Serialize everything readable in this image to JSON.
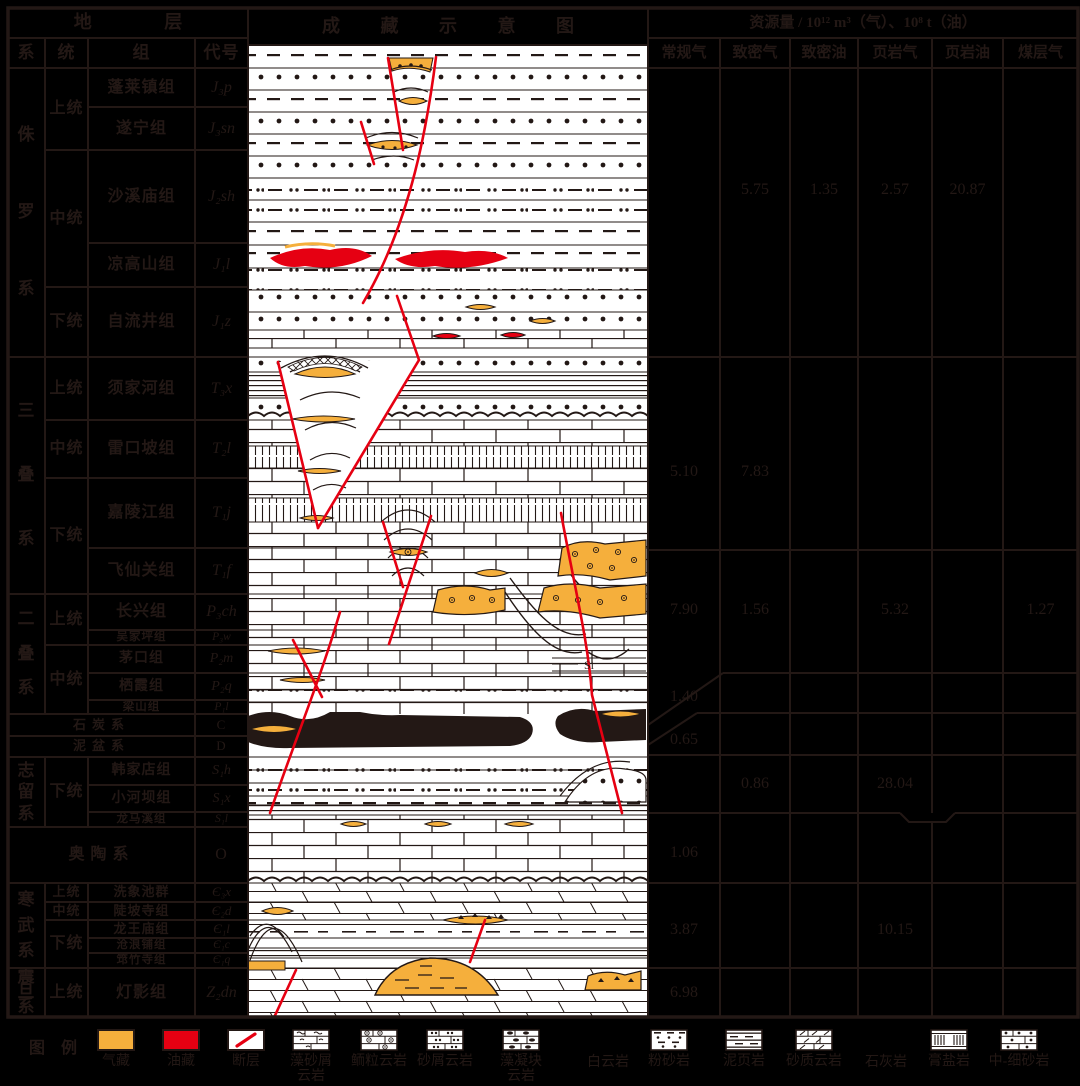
{
  "colors": {
    "ink": "#231815",
    "gas": "#F5AF3C",
    "oil": "#E60012",
    "background": "#000000",
    "paper": "#ffffff"
  },
  "header": {
    "stratum": "地  层",
    "system": "系",
    "series": "统",
    "formation": "组",
    "code": "代号",
    "schematic_title": "成  藏  示  意  图",
    "resource_title": "资源量 / 10¹² m³（气）、10⁸ t（油）",
    "resource_cols": [
      "常规气",
      "致密气",
      "致密油",
      "页岩气",
      "页岩油",
      "煤层气"
    ]
  },
  "strata": {
    "systems": [
      "侏罗系",
      "三叠系",
      "二叠系",
      "志留系",
      "寒武系",
      "震旦系"
    ],
    "series": [
      "上统",
      "中统",
      "下统",
      "上统",
      "中统",
      "下统",
      "上统",
      "中统",
      "下统",
      "上统",
      "中统",
      "下统",
      "上统"
    ],
    "formations": [
      {
        "name": "蓬莱镇组",
        "code": "J₃p"
      },
      {
        "name": "遂宁组",
        "code": "J₃sn"
      },
      {
        "name": "沙溪庙组",
        "code": "J₂sh"
      },
      {
        "name": "凉高山组",
        "code": "J₁l"
      },
      {
        "name": "自流井组",
        "code": "J₁z"
      },
      {
        "name": "须家河组",
        "code": "T₃x"
      },
      {
        "name": "雷口坡组",
        "code": "T₂l"
      },
      {
        "name": "嘉陵江组",
        "code": "T₁j"
      },
      {
        "name": "飞仙关组",
        "code": "T₁f"
      },
      {
        "name": "长兴组",
        "code": "P₃ch"
      },
      {
        "name": "吴家坪组",
        "code": "P₃w"
      },
      {
        "name": "茅口组",
        "code": "P₂m"
      },
      {
        "name": "栖霞组",
        "code": "P₂q"
      },
      {
        "name": "梁山组",
        "code": "P₁l"
      },
      {
        "name": "韩家店组",
        "code": "S₁h"
      },
      {
        "name": "小河坝组",
        "code": "S₁x"
      },
      {
        "name": "龙马溪组",
        "code": "S₁l"
      },
      {
        "name": "洗象池群",
        "code": "Є₃x"
      },
      {
        "name": "陡坡寺组",
        "code": "Є₂d"
      },
      {
        "name": "龙王庙组",
        "code": "Є₁l"
      },
      {
        "name": "沧浪铺组",
        "code": "Є₁c"
      },
      {
        "name": "筇竹寺组",
        "code": "Є₁q"
      },
      {
        "name": "灯影组",
        "code": "Z₂dn"
      }
    ],
    "merged": [
      {
        "name": "石炭系",
        "code": "C"
      },
      {
        "name": "泥盆系",
        "code": "D"
      },
      {
        "name": "奥陶系",
        "code": "O"
      }
    ]
  },
  "resources": {
    "rows": [
      {
        "system": "侏罗系",
        "values": [
          "",
          "5.75",
          "1.35",
          "2.57",
          "20.87",
          ""
        ]
      },
      {
        "system": "三叠系",
        "values": [
          "5.10",
          "7.83",
          "",
          "",
          "",
          ""
        ]
      },
      {
        "system": "二叠系",
        "values": [
          "7.90",
          "1.56",
          "",
          "5.32",
          "",
          "1.27"
        ]
      },
      {
        "system": "石炭系",
        "values": [
          "1.40",
          "",
          "",
          "",
          "",
          ""
        ]
      },
      {
        "system": "泥盆系",
        "values": [
          "0.65",
          "",
          "",
          "",
          "",
          ""
        ]
      },
      {
        "system": "志留系",
        "values": [
          "",
          "0.86",
          "",
          "28.04",
          "",
          ""
        ]
      },
      {
        "system": "奥陶系",
        "values": [
          "1.06",
          "",
          "",
          "",
          "",
          ""
        ]
      },
      {
        "system": "寒武系",
        "values": [
          "3.87",
          "",
          "",
          "10.15",
          "",
          ""
        ]
      },
      {
        "system": "震旦系",
        "values": [
          "6.98",
          "",
          "",
          "",
          "",
          ""
        ]
      }
    ]
  },
  "schematic": {
    "si_label": "Si"
  },
  "legend": {
    "title": "图 例",
    "items": [
      {
        "lines": [
          "气藏"
        ],
        "swatch": "gas"
      },
      {
        "lines": [
          "油藏"
        ],
        "swatch": "oil"
      },
      {
        "lines": [
          "断层"
        ],
        "swatch": "fault"
      },
      {
        "lines": [
          "藻砂屑",
          "云岩"
        ],
        "swatch": "alg-sand"
      },
      {
        "lines": [
          "鲕粒云岩"
        ],
        "swatch": "oolite"
      },
      {
        "lines": [
          "砂屑云岩"
        ],
        "swatch": "sand-debris"
      },
      {
        "lines": [
          "藻凝块",
          "云岩"
        ],
        "swatch": "alg-clot"
      },
      {
        "lines": [
          "白云岩"
        ],
        "swatch": "none"
      },
      {
        "lines": [
          "粉砂岩"
        ],
        "swatch": "silt"
      },
      {
        "lines": [
          "泥页岩"
        ],
        "swatch": "mudshale"
      },
      {
        "lines": [
          "砂质云岩"
        ],
        "swatch": "sandy-dolo"
      },
      {
        "lines": [
          "石灰岩"
        ],
        "swatch": "none"
      },
      {
        "lines": [
          "膏盐岩"
        ],
        "swatch": "gypsum"
      },
      {
        "lines": [
          "中-细砂岩"
        ],
        "swatch": "ms-sand"
      }
    ]
  }
}
